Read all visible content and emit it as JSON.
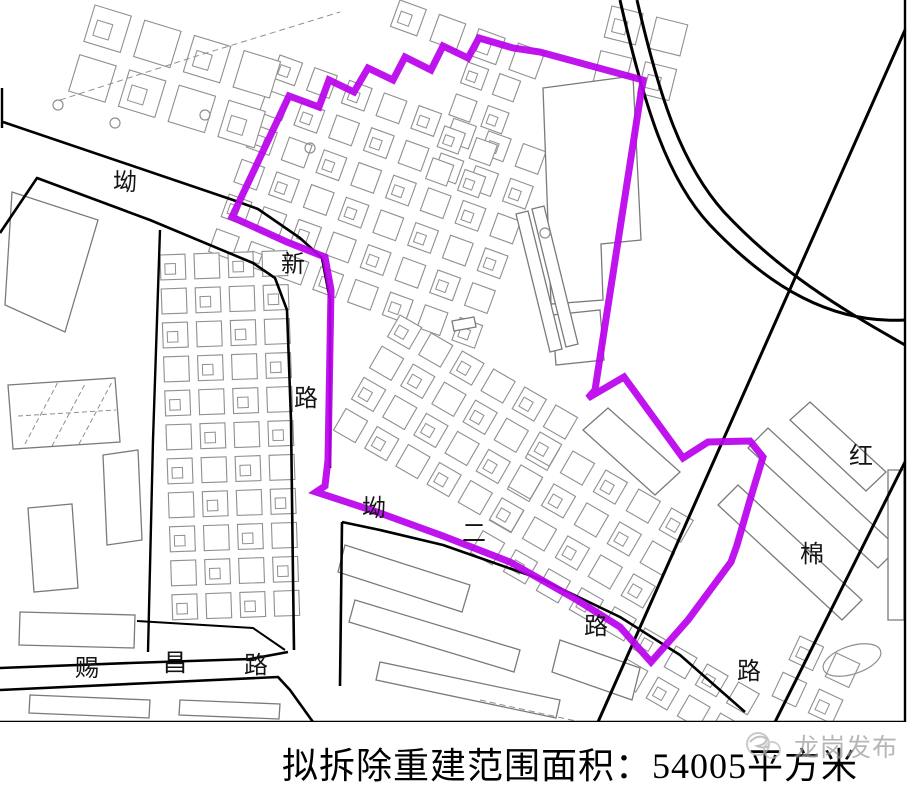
{
  "caption": {
    "text": "拟拆除重建范围面积：54005平方米"
  },
  "watermark": {
    "text": "龙岗发布"
  },
  "colors": {
    "boundary": "#BB00EE",
    "road": "#000000",
    "building_stroke": "#8f8f8f",
    "big_building_stroke": "#7a7a7a",
    "label": "#141414",
    "watermark_gray": "#9b9b9b"
  },
  "map": {
    "width": 912,
    "height": 722,
    "boundary_points": [
      [
        232,
        217
      ],
      [
        289,
        96
      ],
      [
        319,
        107
      ],
      [
        329,
        80
      ],
      [
        354,
        92
      ],
      [
        368,
        68
      ],
      [
        393,
        80
      ],
      [
        405,
        57
      ],
      [
        431,
        70
      ],
      [
        443,
        46
      ],
      [
        468,
        58
      ],
      [
        479,
        38
      ],
      [
        513,
        48
      ],
      [
        540,
        52
      ],
      [
        643,
        80
      ],
      [
        595,
        390
      ],
      [
        588,
        398
      ],
      [
        624,
        377
      ],
      [
        683,
        458
      ],
      [
        708,
        442
      ],
      [
        750,
        441
      ],
      [
        763,
        457
      ],
      [
        750,
        500
      ],
      [
        737,
        545
      ],
      [
        731,
        562
      ],
      [
        688,
        620
      ],
      [
        651,
        662
      ],
      [
        620,
        627
      ],
      [
        577,
        600
      ],
      [
        510,
        562
      ],
      [
        443,
        536
      ],
      [
        377,
        512
      ],
      [
        316,
        492
      ],
      [
        325,
        486
      ],
      [
        328,
        460
      ],
      [
        331,
        290
      ],
      [
        325,
        257
      ],
      [
        287,
        242
      ]
    ],
    "roads": [
      {
        "name": "ao-xin-road-north-edge",
        "w": 2.6,
        "points": [
          [
            3,
            122
          ],
          [
            233,
            200
          ],
          [
            258,
            209
          ],
          [
            300,
            238
          ],
          [
            322,
            258
          ],
          [
            330,
            300
          ],
          [
            330,
            468
          ]
        ]
      },
      {
        "name": "ao-xin-road-south-edge",
        "w": 2.6,
        "points": [
          [
            0,
            233
          ],
          [
            37,
            178
          ],
          [
            150,
            220
          ],
          [
            253,
            263
          ],
          [
            275,
            278
          ],
          [
            287,
            310
          ],
          [
            291,
            420
          ],
          [
            293,
            577
          ],
          [
            294,
            650
          ]
        ]
      },
      {
        "name": "cichang-road-north-edge",
        "w": 2.6,
        "points": [
          [
            0,
            668
          ],
          [
            130,
            663
          ],
          [
            250,
            659
          ],
          [
            288,
            652
          ]
        ]
      },
      {
        "name": "cichang-road-south-edge",
        "w": 2.6,
        "points": [
          [
            0,
            690
          ],
          [
            150,
            683
          ],
          [
            278,
            677
          ],
          [
            290,
            690
          ],
          [
            313,
            722
          ]
        ]
      },
      {
        "name": "block-boundary-vertical",
        "w": 2.6,
        "points": [
          [
            342,
            522
          ],
          [
            340,
            686
          ]
        ]
      },
      {
        "name": "ao-er-road-south-edge",
        "w": 2.6,
        "points": [
          [
            342,
            522
          ],
          [
            380,
            530
          ],
          [
            443,
            545
          ],
          [
            543,
            580
          ],
          [
            620,
            617
          ],
          [
            680,
            655
          ],
          [
            745,
            712
          ]
        ]
      },
      {
        "name": "parcel-line-west",
        "w": 2.4,
        "points": [
          [
            160,
            230
          ],
          [
            153,
            440
          ],
          [
            148,
            652
          ]
        ]
      },
      {
        "name": "block-outline-cichang",
        "w": 2,
        "points": [
          [
            137,
            621
          ],
          [
            253,
            628
          ],
          [
            285,
            650
          ]
        ]
      },
      {
        "name": "diagonal-road-east-1",
        "w": 3,
        "points": [
          [
            905,
            30
          ],
          [
            598,
            722
          ]
        ]
      },
      {
        "name": "diagonal-road-east-2",
        "w": 3,
        "points": [
          [
            905,
            462
          ],
          [
            775,
            722
          ]
        ]
      }
    ],
    "curves": [
      {
        "name": "railway-curve-outer",
        "w": 3,
        "d": "M620,0 C645,110 668,180 710,225 C770,288 832,324 905,320"
      },
      {
        "name": "railway-curve-inner",
        "w": 3,
        "d": "M637,0 C660,100 682,165 724,212 C780,272 838,307 905,345"
      }
    ],
    "border_lines": [
      [
        905,
        0,
        905,
        722
      ],
      [
        0,
        722,
        905,
        722
      ],
      [
        2,
        88,
        2,
        128
      ]
    ],
    "clusters": [
      {
        "x": 280,
        "y": 55,
        "rot": 20,
        "rows": 6,
        "cols": 8,
        "pitch": 37,
        "cell": 24
      },
      {
        "x": 400,
        "y": 315,
        "rot": 30,
        "rows": 4,
        "cols": 6,
        "pitch": 36,
        "cell": 25
      },
      {
        "x": 160,
        "y": 255,
        "rot": -2,
        "rows": 11,
        "cols": 4,
        "pitch": 34,
        "cell": 25
      },
      {
        "x": 540,
        "y": 432,
        "rot": 30,
        "rows": 4,
        "cols": 5,
        "pitch": 38,
        "cell": 25
      },
      {
        "x": 95,
        "y": 5,
        "rot": 17,
        "rows": 2,
        "cols": 4,
        "pitch": 52,
        "cell": 38
      },
      {
        "x": 400,
        "y": 0,
        "rot": 20,
        "rows": 1,
        "cols": 4,
        "pitch": 42,
        "cell": 28
      },
      {
        "x": 468,
        "y": 62,
        "rot": 20,
        "rows": 4,
        "cols": 2,
        "pitch": 34,
        "cell": 22
      },
      {
        "x": 645,
        "y": 628,
        "rot": 30,
        "rows": 2,
        "cols": 4,
        "pitch": 36,
        "cell": 24
      },
      {
        "x": 612,
        "y": 6,
        "rot": 14,
        "rows": 2,
        "cols": 2,
        "pitch": 46,
        "cell": 32
      },
      {
        "x": 800,
        "y": 636,
        "rot": 25,
        "rows": 2,
        "cols": 2,
        "pitch": 40,
        "cell": 26
      }
    ],
    "buildings": [
      [
        [
          543,
          88
        ],
        [
          633,
          76
        ],
        [
          641,
          240
        ],
        [
          601,
          244
        ],
        [
          603,
          300
        ],
        [
          551,
          304
        ]
      ],
      [
        [
          552,
          315
        ],
        [
          600,
          310
        ],
        [
          604,
          360
        ],
        [
          556,
          365
        ]
      ],
      [
        [
          516,
          214
        ],
        [
          528,
          211
        ],
        [
          562,
          349
        ],
        [
          550,
          352
        ]
      ],
      [
        [
          532,
          209
        ],
        [
          544,
          206
        ],
        [
          578,
          344
        ],
        [
          566,
          347
        ]
      ],
      [
        [
          452,
          321
        ],
        [
          474,
          317
        ],
        [
          476,
          327
        ],
        [
          454,
          331
        ]
      ],
      [
        [
          583,
          430
        ],
        [
          608,
          408
        ],
        [
          680,
          472
        ],
        [
          655,
          495
        ]
      ],
      [
        [
          748,
          448
        ],
        [
          768,
          428
        ],
        [
          898,
          548
        ],
        [
          878,
          568
        ]
      ],
      [
        [
          718,
          505
        ],
        [
          738,
          485
        ],
        [
          862,
          600
        ],
        [
          842,
          620
        ]
      ],
      [
        [
          790,
          420
        ],
        [
          810,
          402
        ],
        [
          886,
          472
        ],
        [
          866,
          491
        ]
      ],
      [
        [
          888,
          470
        ],
        [
          904,
          470
        ],
        [
          904,
          620
        ],
        [
          888,
          620
        ]
      ],
      [
        [
          12,
          192
        ],
        [
          98,
          220
        ],
        [
          65,
          332
        ],
        [
          5,
          305
        ]
      ],
      [
        [
          8,
          385
        ],
        [
          115,
          378
        ],
        [
          120,
          442
        ],
        [
          13,
          449
        ]
      ],
      [
        [
          103,
          455
        ],
        [
          138,
          450
        ],
        [
          142,
          540
        ],
        [
          107,
          545
        ]
      ],
      [
        [
          28,
          508
        ],
        [
          72,
          504
        ],
        [
          78,
          588
        ],
        [
          34,
          592
        ]
      ],
      [
        [
          20,
          612
        ],
        [
          135,
          615
        ],
        [
          134,
          648
        ],
        [
          19,
          645
        ]
      ],
      [
        [
          345,
          545
        ],
        [
          470,
          585
        ],
        [
          462,
          612
        ],
        [
          338,
          572
        ]
      ],
      [
        [
          355,
          600
        ],
        [
          520,
          650
        ],
        [
          514,
          672
        ],
        [
          349,
          622
        ]
      ],
      [
        [
          380,
          662
        ],
        [
          560,
          700
        ],
        [
          556,
          718
        ],
        [
          376,
          680
        ]
      ],
      [
        [
          560,
          640
        ],
        [
          640,
          668
        ],
        [
          632,
          700
        ],
        [
          552,
          672
        ]
      ],
      [
        [
          30,
          695
        ],
        [
          150,
          700
        ],
        [
          149,
          718
        ],
        [
          29,
          713
        ]
      ],
      [
        [
          180,
          700
        ],
        [
          280,
          704
        ],
        [
          279,
          719
        ],
        [
          179,
          715
        ]
      ]
    ],
    "hatch_lines": [
      [
        25,
        444,
        58,
        382
      ],
      [
        52,
        446,
        85,
        384
      ],
      [
        79,
        444,
        112,
        382
      ],
      [
        18,
        416,
        116,
        410
      ]
    ],
    "dashed_lines": [
      [
        [
          60,
          100
        ],
        [
          200,
          55
        ],
        [
          340,
          12
        ]
      ],
      [
        [
          480,
          700
        ],
        [
          640,
          735
        ]
      ]
    ],
    "circles": [
      [
        58,
        105
      ],
      [
        115,
        123
      ],
      [
        205,
        115
      ],
      [
        310,
        148
      ],
      [
        545,
        233
      ]
    ],
    "ellipses": [
      {
        "cx": 852,
        "cy": 660,
        "rx": 30,
        "ry": 14,
        "rot": -18
      }
    ],
    "labels": [
      {
        "t": "坳",
        "x": 125,
        "y": 190
      },
      {
        "t": "新",
        "x": 293,
        "y": 272
      },
      {
        "t": "路",
        "x": 306,
        "y": 406
      },
      {
        "t": "坳",
        "x": 374,
        "y": 516
      },
      {
        "t": "二",
        "x": 474,
        "y": 541
      },
      {
        "t": "路",
        "x": 596,
        "y": 634
      },
      {
        "t": "赐",
        "x": 87,
        "y": 676
      },
      {
        "t": "昌",
        "x": 175,
        "y": 671
      },
      {
        "t": "路",
        "x": 256,
        "y": 673
      },
      {
        "t": "红",
        "x": 861,
        "y": 464
      },
      {
        "t": "棉",
        "x": 812,
        "y": 562
      },
      {
        "t": "路",
        "x": 749,
        "y": 679
      }
    ]
  }
}
